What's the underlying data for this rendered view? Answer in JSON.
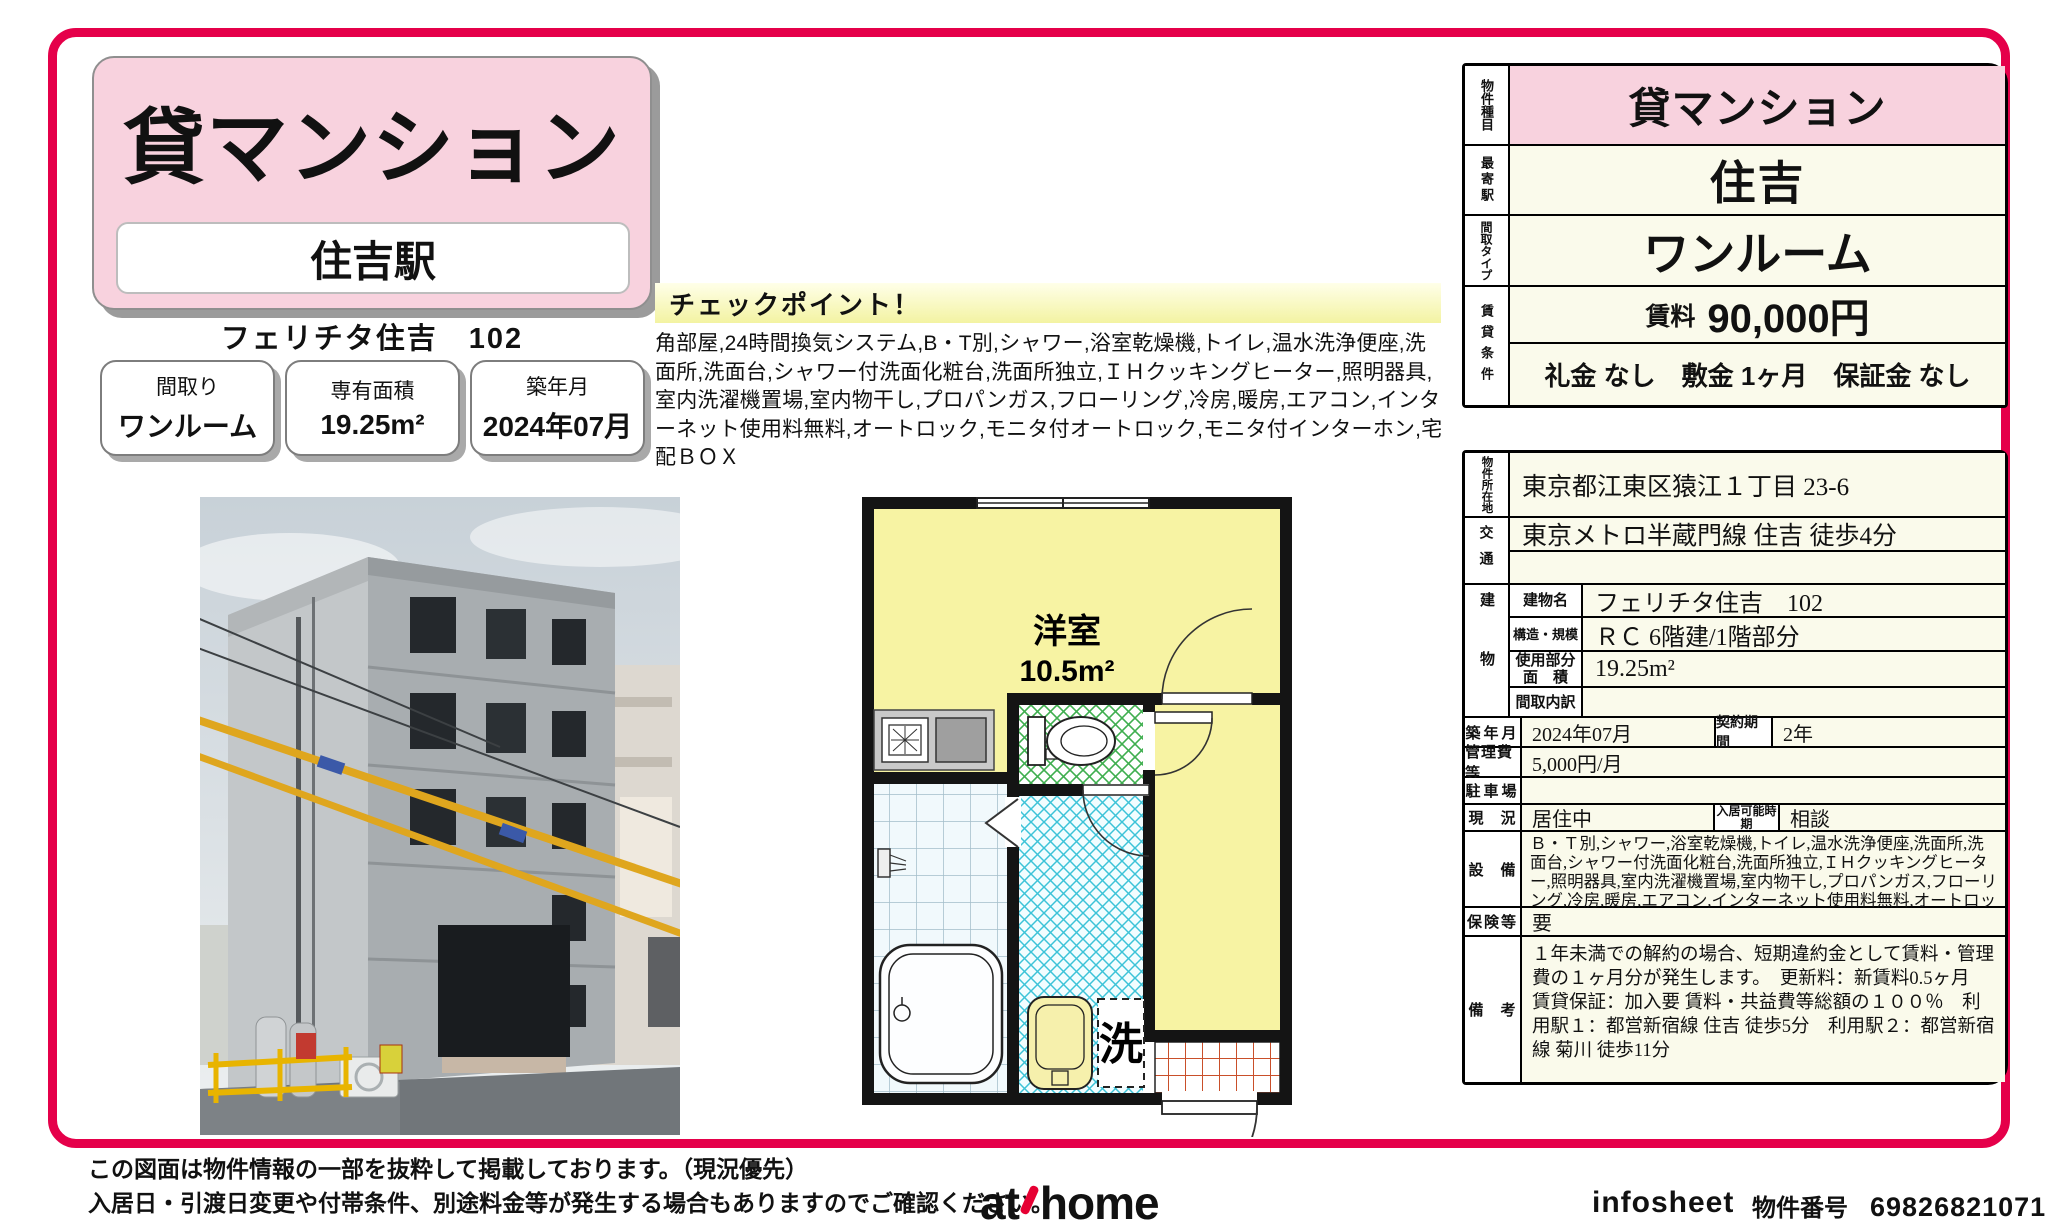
{
  "header": {
    "property_type": "貸マンション",
    "station": "住吉駅",
    "building_title": "フェリチタ住吉　102",
    "spec_boxes": [
      {
        "label": "間取り",
        "value": "ワンルーム"
      },
      {
        "label": "専有面積",
        "value": "19.25m²"
      },
      {
        "label": "築年月",
        "value": "2024年07月"
      }
    ]
  },
  "checkpoint": {
    "title": "チェックポイント！",
    "body": "角部屋,24時間換気システム,B・T別,シャワー,浴室乾燥機,トイレ,温水洗浄便座,洗面所,洗面台,シャワー付洗面化粧台,洗面所独立,ＩＨクッキングヒーター,照明器具,室内洗濯機置場,室内物干し,プロパンガス,フローリング,冷房,暖房,エアコン,インターネット使用料無料,オートロック,モニタ付オートロック,モニタ付インターホン,宅配ＢＯＸ"
  },
  "floorplan": {
    "room_label": "洋室",
    "room_size": "10.5m²",
    "laundry_label": "洗"
  },
  "table_top": {
    "property_type_label": "物件種目",
    "property_type": "貸マンション",
    "nearest_station_label": "最寄駅",
    "nearest_station": "住吉",
    "layout_type_label": "間取タイプ",
    "layout_type": "ワンルーム",
    "rent_conditions_label": "賃貸条件",
    "rent_label": "賃料",
    "rent": "90,000円",
    "fees": "礼金 なし　敷金 1ヶ月　保証金 なし"
  },
  "table_main": {
    "address_label": "物件所在地",
    "address": "東京都江東区猿江１丁目 23-6",
    "access_label": "交通",
    "access": "東京メトロ半蔵門線 住吉 徒歩4分",
    "building_label": "建物",
    "building_name_label": "建物名",
    "building_name": "フェリチタ住吉　102",
    "structure_label": "構造・規模",
    "structure": "ＲＣ 6階建/1階部分",
    "area_label": "使用部分 面　積",
    "area": "19.25m²",
    "layout_detail_label": "間取内訳",
    "built_label": "築年月",
    "built": "2024年07月",
    "contract_label": "契約期間",
    "contract": "2年",
    "mgmt_fee_label": "管理費等",
    "mgmt_fee": "5,000円/月",
    "parking_label": "駐車場",
    "status_label": "現　況",
    "status": "居住中",
    "move_in_label": "入居可能時期",
    "move_in": "相談",
    "equipment_label": "設　備",
    "equipment": "Ｂ・Ｔ別,シャワー,浴室乾燥機,トイレ,温水洗浄便座,洗面所,洗面台,シャワー付洗面化粧台,洗面所独立,ＩＨクッキングヒーター,照明器具,室内洗濯機置場,室内物干し,プロパンガス,フローリング,冷房,暖房,エアコン,インターネット使用料無料,オートロック,モニタ付オートロック,モニタ付...",
    "insurance_label": "保険等",
    "insurance": "要",
    "notes_label": "備　考",
    "notes": "１年未満での解約の場合、短期違約金として賃料・管理費の１ヶ月分が発生します。　更新料：新賃料0.5ヶ月　賃貸保証：加入要 賃料・共益費等総額の１００％　利用駅１：都営新宿線 住吉 徒歩5分　利用駅２：都営新宿線 菊川 徒歩11分"
  },
  "footer": {
    "disclaimer_line1": "この図面は物件情報の一部を抜粋して掲載しております。（現況優先）",
    "disclaimer_line2": "入居日・引渡日変更や付帯条件、別途料金等が発生する場合もありますのでご確認ください。",
    "logo_at": "at",
    "logo_home": "home",
    "brand": "infosheet",
    "property_no_label": "物件番号",
    "property_no": "69826821071"
  },
  "colors": {
    "accent": "#e5004a",
    "pink": "#f8d2de",
    "cream": "#fafaeb",
    "plan_yellow": "#f7f3a3"
  }
}
